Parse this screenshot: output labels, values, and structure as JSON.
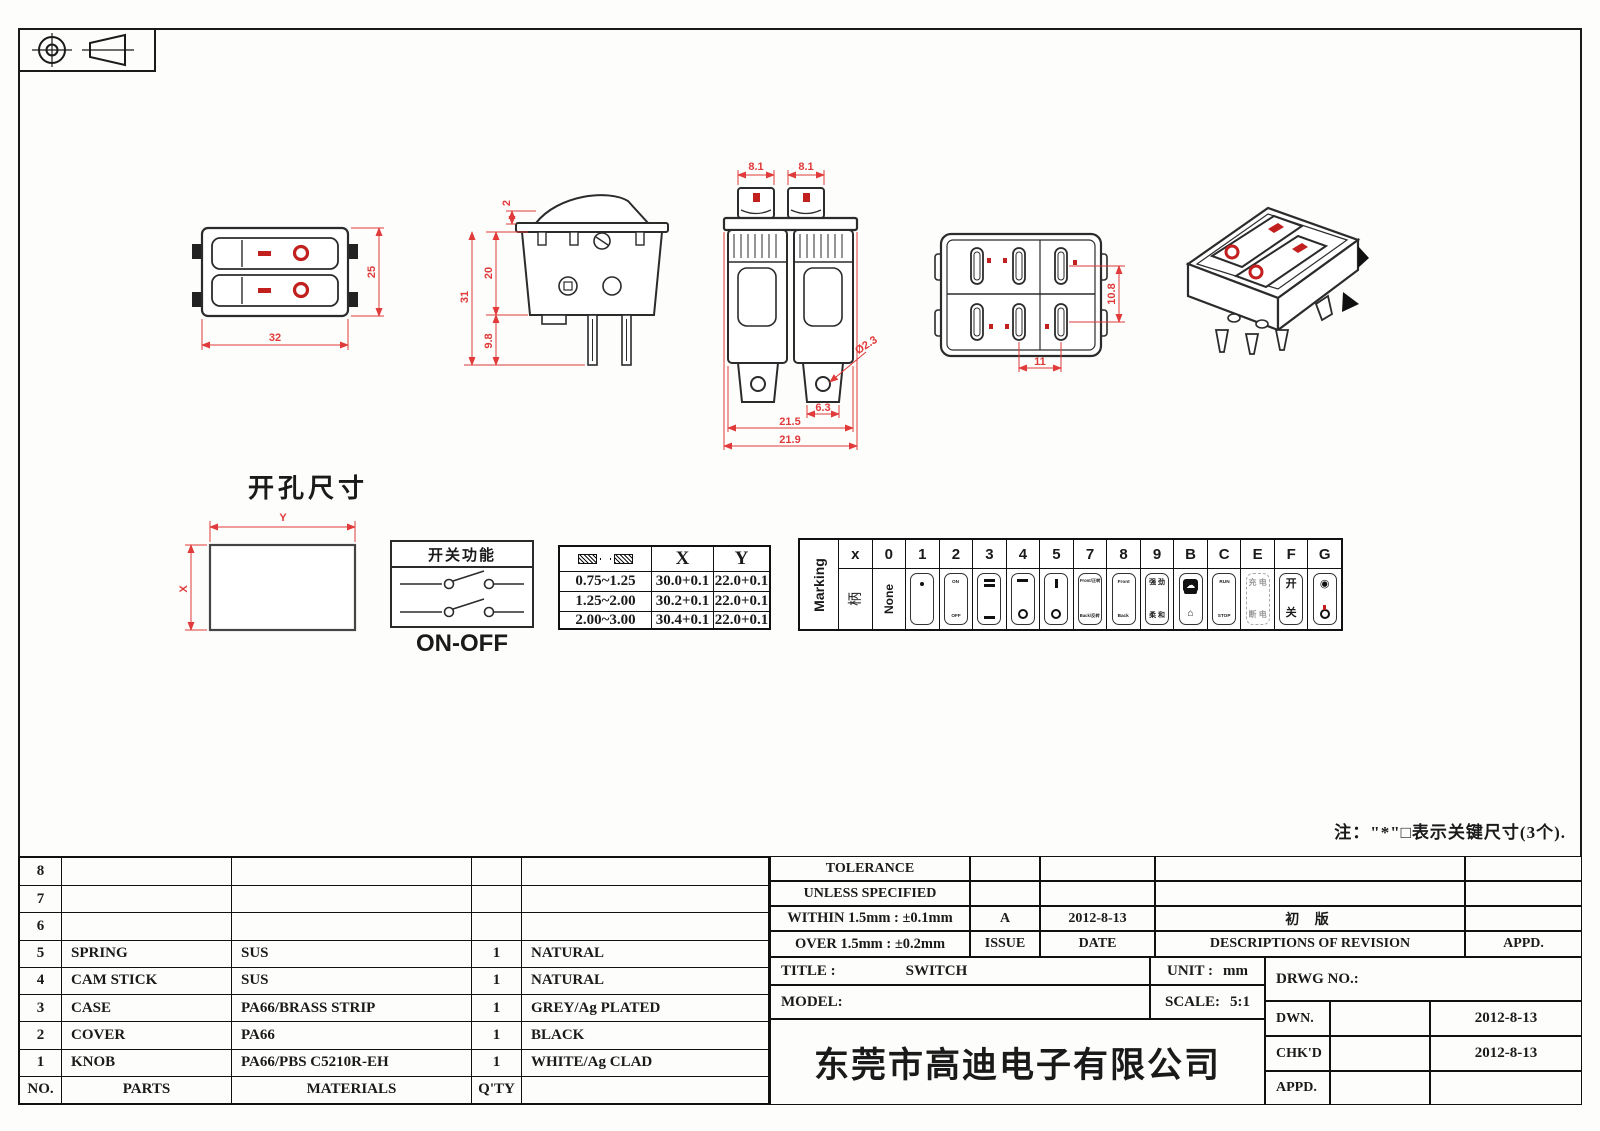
{
  "colors": {
    "dim_red": "#e03a3a",
    "mark_red": "#c21f1f",
    "line_dark": "#2b2b2b"
  },
  "projection": {
    "name": "first-angle-projection"
  },
  "dims": {
    "front_w": "32",
    "front_h": "25",
    "side_top": "2",
    "side_body": "20",
    "side_pin": "9.8",
    "side_total": "31",
    "end_knob_l": "8.1",
    "end_knob_r": "8.1",
    "end_hole": "Ø2.3",
    "end_term": "6.3",
    "end_body": "21.5",
    "end_overall": "21.9",
    "bot_v": "10.8",
    "bot_h": "11"
  },
  "cutout": {
    "title": "开孔尺寸",
    "x": "X",
    "y": "Y"
  },
  "function_box": {
    "title": "开关功能",
    "label": "ON-OFF"
  },
  "panel_table": {
    "col_x": "X",
    "col_y": "Y",
    "rows": [
      [
        "0.75~1.25",
        "30.0+0.1",
        "22.0+0.1"
      ],
      [
        "1.25~2.00",
        "30.2+0.1",
        "22.0+0.1"
      ],
      [
        "2.00~3.00",
        "30.4+0.1",
        "22.0+0.1"
      ]
    ]
  },
  "marking": {
    "label": "Marking",
    "handle": "柄",
    "codes": [
      "x",
      "0",
      "1",
      "2",
      "3",
      "4",
      "5",
      "7",
      "8",
      "9",
      "B",
      "C",
      "E",
      "F",
      "G"
    ],
    "cells": {
      "none": "None",
      "on": "ON",
      "off": "OFF",
      "front7": "Front/正转",
      "back7": "Back/反转",
      "front8": "Front",
      "back8": "Back",
      "strong": "强 劲",
      "soft": "柔 和",
      "cloud": "☁",
      "house": "⌂",
      "run": "RUN",
      "stop": "STOP",
      "charge": "充 电",
      "discharge": "断 电",
      "kai": "开",
      "guan": "关",
      "target": "◉"
    }
  },
  "note": {
    "text": "注：\"*\"□表示关键尺寸(3个)."
  },
  "parts_table": {
    "headers": {
      "no": "NO.",
      "parts": "PARTS",
      "materials": "MATERIALS",
      "qty": "Q'TY",
      "finish": ""
    },
    "rows": [
      {
        "no": "8",
        "parts": "",
        "materials": "",
        "qty": "",
        "finish": ""
      },
      {
        "no": "7",
        "parts": "",
        "materials": "",
        "qty": "",
        "finish": ""
      },
      {
        "no": "6",
        "parts": "",
        "materials": "",
        "qty": "",
        "finish": ""
      },
      {
        "no": "5",
        "parts": "SPRING",
        "materials": "SUS",
        "qty": "1",
        "finish": "NATURAL"
      },
      {
        "no": "4",
        "parts": "CAM STICK",
        "materials": "SUS",
        "qty": "1",
        "finish": "NATURAL"
      },
      {
        "no": "3",
        "parts": "CASE",
        "materials": "PA66/BRASS STRIP",
        "qty": "1",
        "finish": "GREY/Ag PLATED"
      },
      {
        "no": "2",
        "parts": "COVER",
        "materials": "PA66",
        "qty": "1",
        "finish": "BLACK"
      },
      {
        "no": "1",
        "parts": "KNOB",
        "materials": "PA66/PBS C5210R-EH",
        "qty": "1",
        "finish": "WHITE/Ag CLAD"
      }
    ]
  },
  "title_block": {
    "tolerance1": "TOLERANCE",
    "tolerance2": "UNLESS  SPECIFIED",
    "within": "WITHIN 1.5mm : ±0.1mm",
    "over": "OVER 1.5mm : ±0.2mm",
    "issue_value": "A",
    "issue_label": "ISSUE",
    "date_value": "2012-8-13",
    "date_label": "DATE",
    "revision_value": "初 版",
    "revision_label": "DESCRIPTIONS OF REVISION",
    "appd_label": "APPD.",
    "title_label": "TITLE :",
    "title_value": "SWITCH",
    "unit_label": "UNIT :",
    "unit_value": "mm",
    "drwg_label": "DRWG NO.:",
    "model_label": "MODEL:",
    "scale_label": "SCALE:",
    "scale_value": "5:1",
    "dwn_label": "DWN.",
    "dwn_date": "2012-8-13",
    "chkd_label": "CHK'D",
    "chkd_date": "2012-8-13",
    "appd2_label": "APPD.",
    "company": "东莞市高迪电子有限公司"
  }
}
